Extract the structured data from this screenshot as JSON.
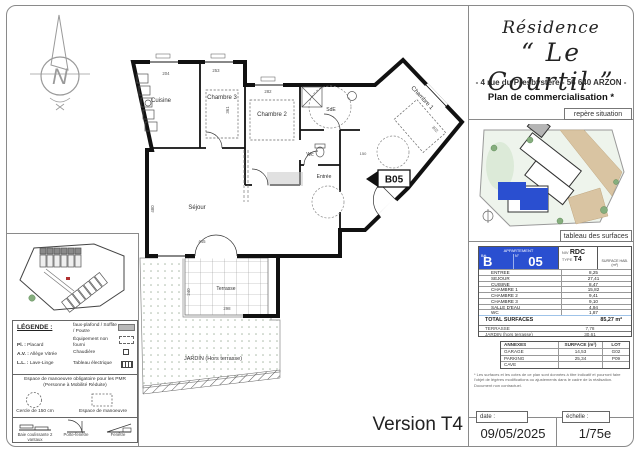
{
  "sheet": {
    "version_label": "Version T4"
  },
  "title_block": {
    "residence": "Résidence",
    "name": "“ Le Courtil ”",
    "address": "- 4 rue du Presbystère - 56 640 ARZON -",
    "subtitle": "Plan de commercialisation *"
  },
  "tabs": {
    "situation": "repère situation",
    "surfaces": "tableau des surfaces"
  },
  "surface_table": {
    "appartement_label": "APPARTEMENT",
    "bat_label": "Bât.",
    "num_label": "N°",
    "bat": "B",
    "num": "05",
    "niv_label": "NIV",
    "niv": "RDC",
    "type_label": "TYPE",
    "type": "T4",
    "surface_col": "SURFACE HAB. (m²)",
    "rows": [
      {
        "label": "ENTREE",
        "value": "8,25"
      },
      {
        "label": "SEJOUR",
        "value": "27,41"
      },
      {
        "label": "CUISINE",
        "value": "8,47"
      },
      {
        "label": "CHAMBRE 1",
        "value": "15,82"
      },
      {
        "label": "CHAMBRE 2",
        "value": "9,41"
      },
      {
        "label": "CHAMBRE 3",
        "value": "9,10"
      },
      {
        "label": "SALLE D'EAU",
        "value": "4,94"
      },
      {
        "label": "WC",
        "value": "1,87"
      }
    ],
    "total_label": "TOTAL SURFACES",
    "total": "85,27 m²",
    "extra_rows": [
      {
        "label": "TERRASSE",
        "value": "7,78"
      },
      {
        "label": "JARDIN (hors terrasse)",
        "value": "30,61"
      }
    ]
  },
  "annexes_table": {
    "col_annexes": "ANNEXES",
    "col_surface": "SURFACE (m²)",
    "col_lot": "LOT",
    "rows": [
      {
        "label": "GARAGE",
        "surface": "14,53",
        "lot": "G02"
      },
      {
        "label": "PARKING",
        "surface": "25,34",
        "lot": "P09"
      },
      {
        "label": "CAVE",
        "surface": "",
        "lot": ""
      }
    ]
  },
  "disclaimer": "* Les surfaces et les cotes de ce plan sont données à titre indicatif et pourront faire l'objet de légères modifications ou ajustements dans le cadre de la réalisation. Document non contractuel.",
  "footer": {
    "date_label": "date :",
    "date": "09/05/2025",
    "scale_label": "échelle :",
    "scale": "1/75e"
  },
  "plan": {
    "unit": "B05",
    "rooms": {
      "cuisine": "Cuisine",
      "chambre3": "Chambre 3",
      "chambre2": "Chambre 2",
      "chambre1": "Chambre 1",
      "sde": "SdE",
      "wc": "Wc",
      "entree": "Entrée",
      "sejour": "Séjour",
      "terrasse": "Terrasse",
      "jardin": "JARDIN (Hors terrasse)"
    },
    "dims": {
      "d204": "204",
      "d253": "253",
      "d282": "282",
      "d361": "361",
      "d480": "480",
      "d445": "445",
      "d240": "240",
      "d298": "298",
      "d150": "150",
      "d302": "302"
    }
  },
  "legend": {
    "title": "LÉGENDE :",
    "abbr": [
      {
        "k": "Pl. :",
        "v": "Placard"
      },
      {
        "k": "A.V. :",
        "v": "Allège Vitrée"
      },
      {
        "k": "L.L. :",
        "v": "Lave-Linge"
      }
    ],
    "items": [
      {
        "label": "faux-plafond / Soffite / Poutre"
      },
      {
        "label": "Équipement non fourni"
      },
      {
        "label": "Chaudière"
      },
      {
        "label": "Tableau électrique"
      }
    ],
    "pmr_title": "Espace de manoeuvre obligatoire pour les PMR (Personne à Mobilité Réduite)",
    "pmr_circle": "Cercle de 150 cm",
    "pmr_space": "Espace de manoeuvre",
    "symbols": [
      {
        "label": "Baie coulissante 2 vantaux"
      },
      {
        "label": "Porte-fenêtre"
      },
      {
        "label": "Fenêtre"
      }
    ]
  },
  "compass": {
    "letter": "N"
  },
  "colors": {
    "accent_blue": "#2a4fd0",
    "tan": "#d9c4a2",
    "wall": "#111111"
  }
}
